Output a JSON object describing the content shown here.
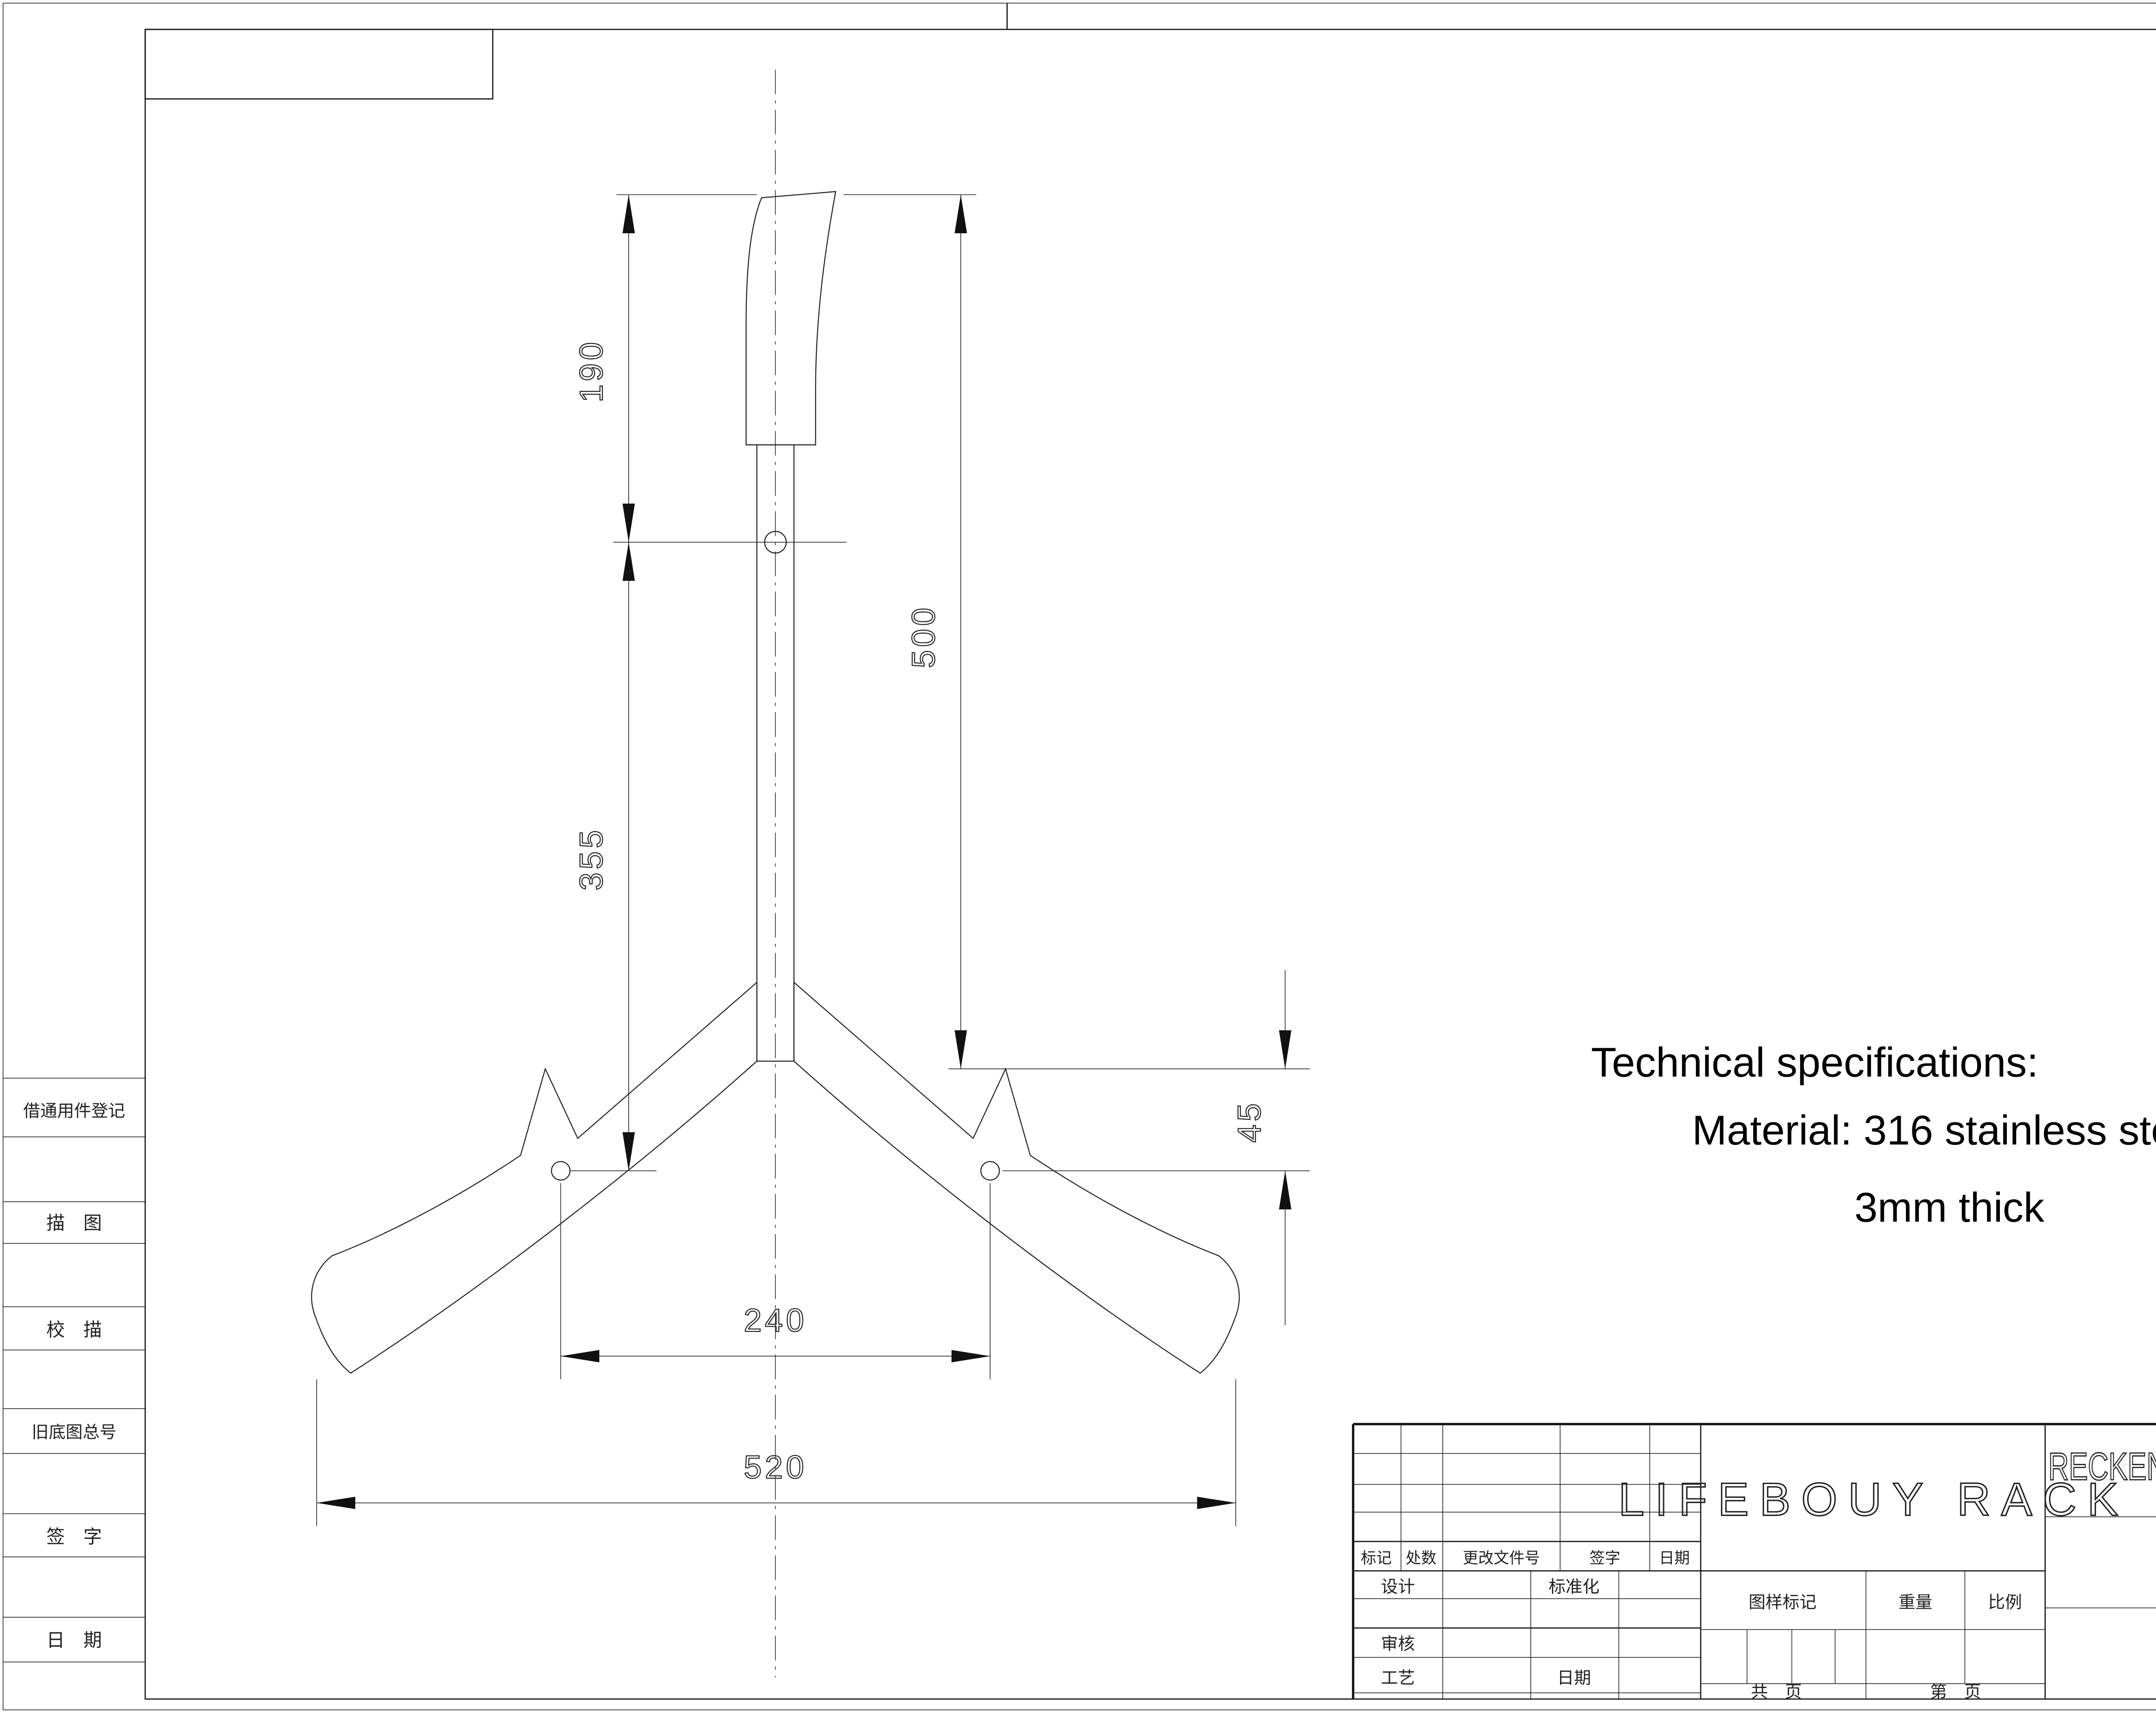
{
  "colors": {
    "background": "#ffffff",
    "line": "#1f1f1f"
  },
  "margin_column": {
    "labels": [
      "借通用件登记",
      "描　图",
      "校　描",
      "旧底图总号",
      "签　字",
      "日　期"
    ]
  },
  "drawing": {
    "notes": {
      "line1": "Technical specifications:",
      "line2": "Material: 316 stainless steel",
      "line3": "3mm thick"
    },
    "dimensions": {
      "hook_length": "190",
      "hole_to_hole_vertical": "355",
      "overall_height": "500",
      "tip_drop": "45",
      "hole_spacing": "240",
      "overall_width": "520"
    }
  },
  "title_block": {
    "part_name": "LIFEBOUY RACK",
    "company": "RECKEN MARINE LIMITED",
    "revision": "REV.0",
    "revision_header": [
      "标记",
      "处数",
      "更改文件号",
      "签字",
      "日期"
    ],
    "roles": {
      "design": "设计",
      "standardization": "标准化",
      "check": "审核",
      "process": "工艺",
      "date": "日期"
    },
    "fields": {
      "drawing_mark": "图样标记",
      "weight": "重量",
      "scale": "比例",
      "total_sheets": "共　页",
      "sheet_no": "第　页"
    }
  }
}
